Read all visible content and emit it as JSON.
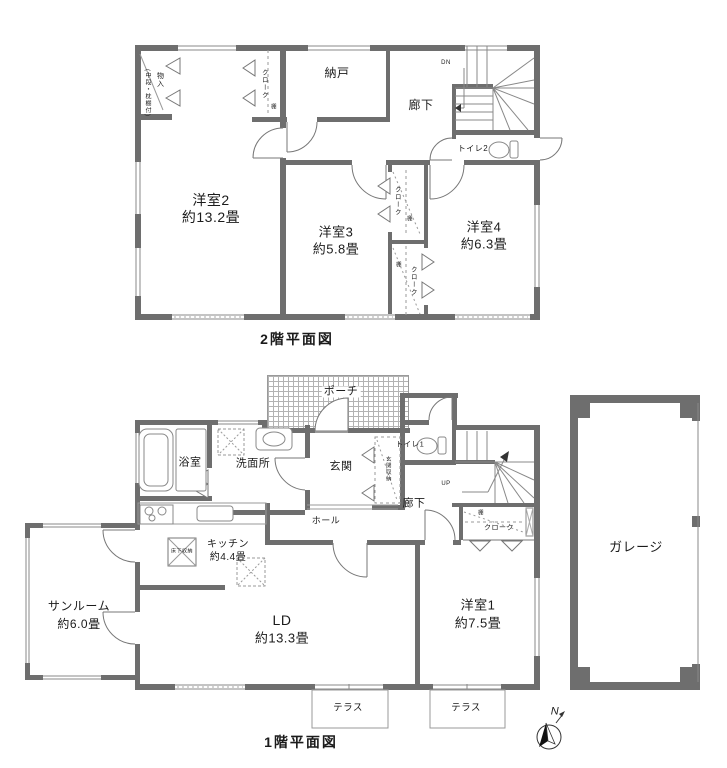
{
  "floor2": {
    "title": "2階平面図",
    "rooms": {
      "yoshitsu2": {
        "name": "洋室2",
        "size": "約13.2畳"
      },
      "yoshitsu3": {
        "name": "洋室3",
        "size": "約5.8畳"
      },
      "yoshitsu4": {
        "name": "洋室4",
        "size": "約6.3畳"
      },
      "nando": {
        "name": "納戸"
      },
      "rouka": {
        "name": "廊下"
      },
      "toilet": {
        "name": "トイレ2"
      },
      "monoire": {
        "name": "物入",
        "note": "(中段・枕棚付)"
      },
      "closet_top": {
        "name": "クローク",
        "shelf": "棚"
      },
      "closet_a": {
        "name": "クローク",
        "shelf": "棚"
      },
      "closet_b": {
        "name": "クローク",
        "shelf": "棚"
      },
      "stairs": {
        "direction": "DN"
      }
    }
  },
  "floor1": {
    "title": "1階平面図",
    "rooms": {
      "ld": {
        "name": "LD",
        "size": "約13.3畳"
      },
      "kitchen": {
        "name": "キッチン",
        "size": "約4.4畳"
      },
      "sunroom": {
        "name": "サンルーム",
        "size": "約6.0畳"
      },
      "yoshitsu1": {
        "name": "洋室1",
        "size": "約7.5畳"
      },
      "porch": {
        "name": "ポーチ"
      },
      "genkan": {
        "name": "玄関"
      },
      "genkan_shuno": {
        "name": "玄関収納"
      },
      "toilet": {
        "name": "トイレ1"
      },
      "senmenjo": {
        "name": "洗面所"
      },
      "yokushitsu": {
        "name": "浴室"
      },
      "hall": {
        "name": "ホール"
      },
      "rouka": {
        "name": "廊下"
      },
      "yukashita": {
        "name": "床下収納"
      },
      "closet": {
        "name": "クローク",
        "shelf": "棚"
      },
      "stairs": {
        "direction": "UP"
      },
      "terrace1": {
        "name": "テラス"
      },
      "terrace2": {
        "name": "テラス"
      }
    }
  },
  "garage": {
    "name": "ガレージ"
  },
  "compass": {
    "north": "N"
  },
  "colors": {
    "wall": "#6e6e6e",
    "line": "#777777",
    "background": "#ffffff"
  }
}
